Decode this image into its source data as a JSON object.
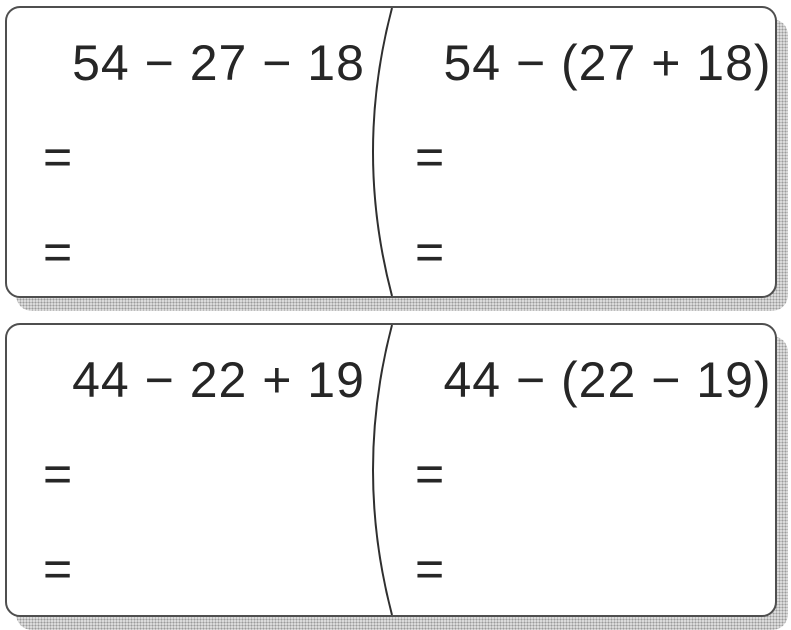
{
  "worksheet": {
    "type": "math-practice-cards",
    "colors": {
      "background": "#ffffff",
      "text": "#2a2a2a",
      "card_border": "#4f4f4f",
      "divider_line": "#2f2f2f",
      "shadow": "#c9c9c9"
    },
    "cards": [
      {
        "left": {
          "expression": "54 − 27 − 18",
          "answer_lines": [
            "=",
            "="
          ]
        },
        "right": {
          "expression": "54 − (27 + 18)",
          "answer_lines": [
            "=",
            "="
          ]
        }
      },
      {
        "left": {
          "expression": "44 − 22 + 19",
          "answer_lines": [
            "=",
            "="
          ]
        },
        "right": {
          "expression": "44 − (22 − 19)",
          "answer_lines": [
            "=",
            "="
          ]
        }
      }
    ]
  }
}
